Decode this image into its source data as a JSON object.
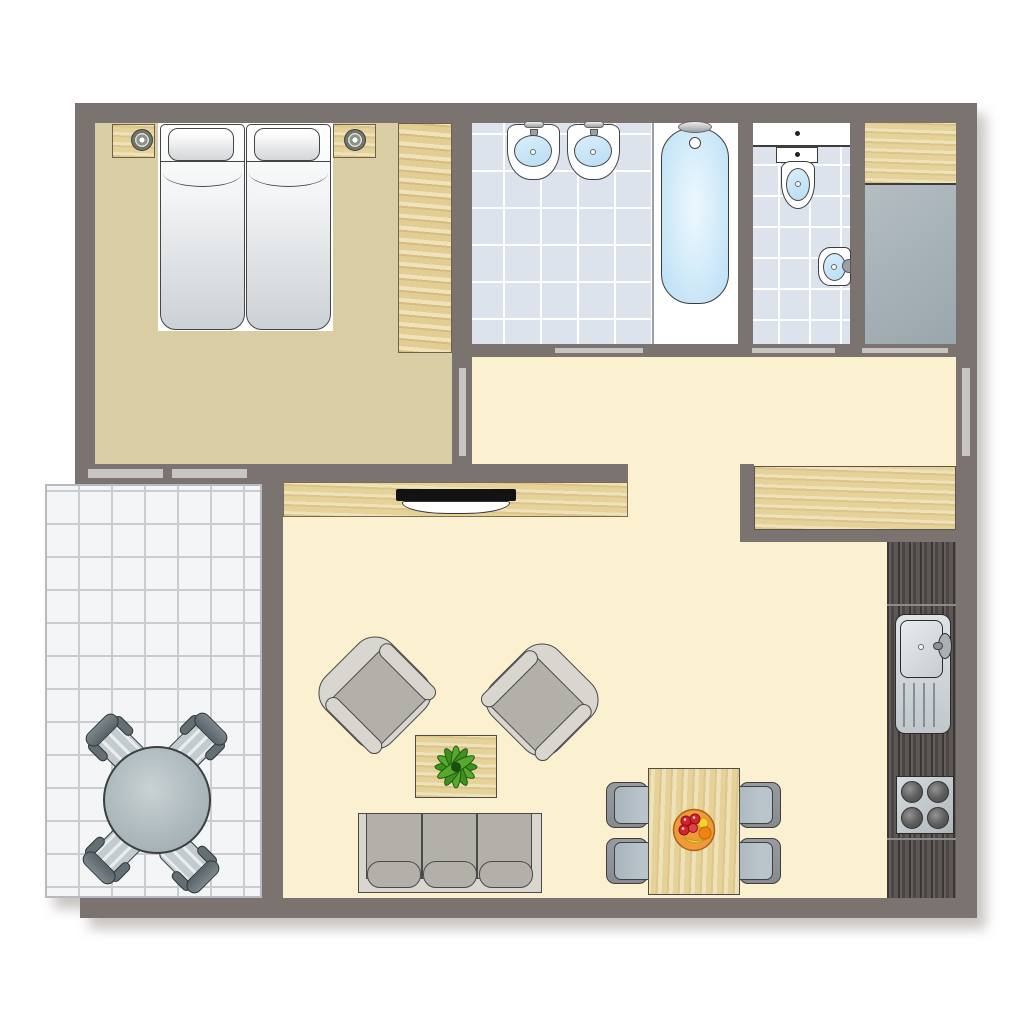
{
  "app": {
    "type": "floor-plan",
    "description": "Top-down 2D apartment floor plan with furnished rooms, no text labels"
  },
  "palette": {
    "wall": "#7b7370",
    "outline": "#454545",
    "bedroom_floor": "#d9cda4",
    "cream_floor": "#fbf1d1",
    "bath_tile": "#dde3ed",
    "grout": "#ffffff",
    "storage_floor": "#a9b3b9",
    "terrace_tile": "#f4f5f7",
    "terrace_grout": "#c9ccd1",
    "wood": "#e9d79f",
    "wood_dark": "#57514e",
    "door_bar": "#c6c5c3",
    "water_light": "#d9eefb",
    "water": "#b9ddf4",
    "metal": "#aab0b4",
    "gray_cushion": "#b3b0aa",
    "gray_frame": "#d9d6cf",
    "chair_seat": "#b9c4cb",
    "chair_back": "#878b8f",
    "mattress_shade": "#ccd1d5"
  },
  "rooms": [
    {
      "id": "bedroom",
      "label": "Bedroom",
      "fixtures": [
        "double-bed",
        "pillow x2",
        "nightstand x2",
        "table-lamp x2",
        "wardrobe"
      ]
    },
    {
      "id": "bathroom",
      "label": "Bathroom",
      "fixtures": [
        "washbasin x2",
        "bathtub",
        "bath-faucet"
      ]
    },
    {
      "id": "wc",
      "label": "WC",
      "fixtures": [
        "toilet",
        "bidet",
        "wall-shelf"
      ]
    },
    {
      "id": "storage",
      "label": "Storage room",
      "fixtures": [
        "shelf"
      ]
    },
    {
      "id": "hallway",
      "label": "Hallway",
      "fixtures": [
        "counter-cabinet"
      ]
    },
    {
      "id": "living-room",
      "label": "Living room",
      "fixtures": [
        "sideboard",
        "tv",
        "armchair x2",
        "coffee-table",
        "potted-plant",
        "sofa-3-seat",
        "dining-table",
        "fruit-bowl",
        "dining-chair x4"
      ]
    },
    {
      "id": "kitchen",
      "label": "Kitchenette",
      "fixtures": [
        "kitchen-sink",
        "stove-4-burners",
        "dark-counter"
      ]
    },
    {
      "id": "terrace",
      "label": "Terrace",
      "fixtures": [
        "round-table",
        "terrace-chair x4"
      ]
    }
  ],
  "openings": {
    "doors": [
      "bathroom-door",
      "wc-door",
      "storage-door",
      "bedroom-door"
    ],
    "windows": [
      "bedroom-terrace-window x2",
      "hallway-window"
    ]
  }
}
